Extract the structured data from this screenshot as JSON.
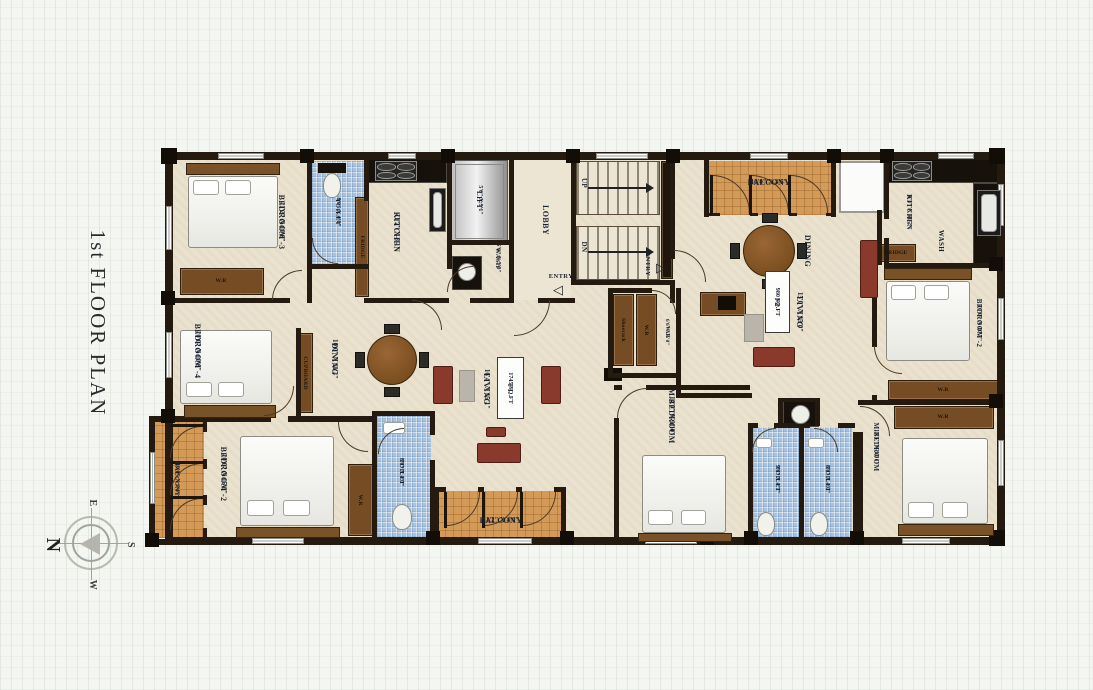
{
  "title": "1st FLOOR PLAN",
  "compass": {
    "n": "N",
    "e": "E",
    "s": "S",
    "w": "W"
  },
  "units": {
    "f1": {
      "tag": "F1",
      "area": "1745 SQ.FT"
    },
    "f2": {
      "tag": "F2",
      "area": "980 SQ.FT"
    }
  },
  "rooms": {
    "bedroom3": {
      "name": "BEDROOM -3",
      "dims": "11'2\" X 10'6\""
    },
    "toilet_top": {
      "name": "TOILET",
      "dims": "8'0\" X 4'0\""
    },
    "kitchen_f1": {
      "name": "KITCHEN",
      "dims": "11'2\" X 8'1\""
    },
    "lift": {
      "name": "LIFT",
      "dims": "5'6\" X 5'1\""
    },
    "wash_f1": {
      "name": "WASH",
      "dims": "5'0\" X 5'0\""
    },
    "lobby": {
      "name": "LOBBY"
    },
    "stairs": {
      "up": "UP",
      "dn": "DN"
    },
    "entry": {
      "name": "ENTRY"
    },
    "balcony_f2": {
      "name": "BALCONY",
      "dims": "10'0\" X 3'6\""
    },
    "dining_f2": {
      "name": "DINING"
    },
    "living_f2": {
      "name": "LIVING",
      "dims": "15'0\" X 13'0\""
    },
    "kitchen_f2": {
      "name": "KITCHEN",
      "dims": "8'1\" X 11'2\""
    },
    "wash_f2": {
      "name": "WASH"
    },
    "fridge": {
      "name": "FRIDGE"
    },
    "bedroom2_f2": {
      "name": "BEDROOM -2",
      "dims": "10'0\" X 10'7\""
    },
    "mbedroom_f2": {
      "name": "M.BEDROOM",
      "dims": "13'1\" X 11'1\""
    },
    "toilet_m1": {
      "name": "TOILET",
      "dims": "9'6\" X 4'7\""
    },
    "toilet_m2": {
      "name": "TOILET",
      "dims": "8'0\" X 4'0\""
    },
    "mbedroom_f1": {
      "name": "M.BEDROOM",
      "dims": "14'0\" X 11'0\""
    },
    "wr_dims": {
      "name": "W.R",
      "dims": "6'6\" X 5'0\""
    },
    "shoerack": {
      "name": "Shoerack"
    },
    "wr": {
      "name": "W.R"
    },
    "cupboard": {
      "name": "CUPBOARD"
    },
    "bedroom4": {
      "name": "BEDROOM -4",
      "dims": "10'0\" X 10'6\""
    },
    "dining_f1": {
      "name": "DINING",
      "dims": "10'0\" X 11'3\""
    },
    "living_f1": {
      "name": "LIVING",
      "dims": "16'4\" X 15'1\""
    },
    "balcony_left": {
      "name": "BALCONY",
      "dims": "10'0\" X 3'4\""
    },
    "bedroom2_f1": {
      "name": "BEDROOM -2",
      "dims": "10'0\" X 15'0\""
    },
    "toilet_bottom": {
      "name": "TOILET",
      "dims": "8'0\" X 4'0\""
    },
    "balcony_bottom": {
      "name": "BALCONY",
      "dims": "11'2\" X 4'0\""
    }
  },
  "icons": {
    "entry_arrow_left": "◁",
    "entry_arrow_right": "▷"
  },
  "colors": {
    "wall": "#241a10",
    "floor": "#eae2cf",
    "balcony_tile": "#d39a58",
    "toilet_tile": "#a9c3de",
    "wood": "#764c24",
    "sofa": "#8a3a2c",
    "lift": "#c9c9c9",
    "label_text": "#1a2330"
  }
}
